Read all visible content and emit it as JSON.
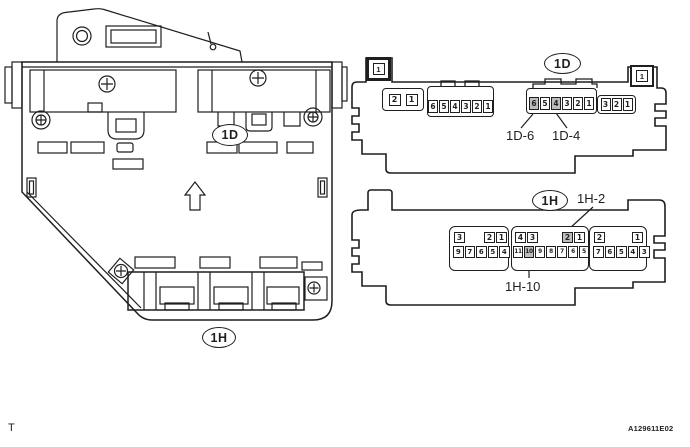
{
  "figure": {
    "footer_left": "T",
    "code": "A129611E02",
    "line_color": "#1f1f1f",
    "highlight_color": "#bdbdbd"
  },
  "left_view": {
    "connector_labels": {
      "d": "1D",
      "h": "1H"
    }
  },
  "panel_1d": {
    "label": "1D",
    "corner_left_pin": "1",
    "corner_right_pin": "1",
    "callout_6": "1D-6",
    "callout_4": "1D-4",
    "conn_a_pins": [
      {
        "n": "2",
        "hl": false
      },
      {
        "n": "1",
        "hl": false
      }
    ],
    "conn_b_pins": [
      {
        "n": "6",
        "hl": false
      },
      {
        "n": "5",
        "hl": false
      },
      {
        "n": "4",
        "hl": false
      },
      {
        "n": "3",
        "hl": false
      },
      {
        "n": "2",
        "hl": false
      },
      {
        "n": "1",
        "hl": false
      }
    ],
    "conn_c_pins": [
      {
        "n": "6",
        "hl": true
      },
      {
        "n": "5",
        "hl": false
      },
      {
        "n": "4",
        "hl": true
      },
      {
        "n": "3",
        "hl": false
      },
      {
        "n": "2",
        "hl": false
      },
      {
        "n": "1",
        "hl": false
      }
    ],
    "conn_d_pins": [
      {
        "n": "3",
        "hl": false
      },
      {
        "n": "2",
        "hl": false
      },
      {
        "n": "1",
        "hl": false
      }
    ]
  },
  "panel_1h": {
    "label": "1H",
    "callout_2": "1H-2",
    "callout_10": "1H-10",
    "block_left": {
      "top_a": [
        {
          "n": "3",
          "hl": false
        }
      ],
      "top_b": [
        {
          "n": "2",
          "hl": false
        },
        {
          "n": "1",
          "hl": false
        }
      ],
      "bottom": [
        {
          "n": "9",
          "hl": false
        },
        {
          "n": "7",
          "hl": false
        },
        {
          "n": "6",
          "hl": false
        },
        {
          "n": "5",
          "hl": false
        },
        {
          "n": "4",
          "hl": false
        }
      ]
    },
    "block_mid": {
      "top_a": [
        {
          "n": "4",
          "hl": false
        },
        {
          "n": "3",
          "hl": false
        }
      ],
      "top_b": [
        {
          "n": "2",
          "hl": true
        },
        {
          "n": "1",
          "hl": false
        }
      ],
      "bottom": [
        {
          "n": "11",
          "hl": false
        },
        {
          "n": "10",
          "hl": true
        },
        {
          "n": "9",
          "hl": false
        },
        {
          "n": "8",
          "hl": false
        },
        {
          "n": "7",
          "hl": false
        },
        {
          "n": "6",
          "hl": false
        },
        {
          "n": "5",
          "hl": false
        }
      ]
    },
    "block_right": {
      "top_a": [
        {
          "n": "2",
          "hl": false
        }
      ],
      "top_b": [
        {
          "n": "1",
          "hl": false
        }
      ],
      "bottom": [
        {
          "n": "7",
          "hl": false
        },
        {
          "n": "6",
          "hl": false
        },
        {
          "n": "5",
          "hl": false
        },
        {
          "n": "4",
          "hl": false
        },
        {
          "n": "3",
          "hl": false
        }
      ]
    }
  }
}
